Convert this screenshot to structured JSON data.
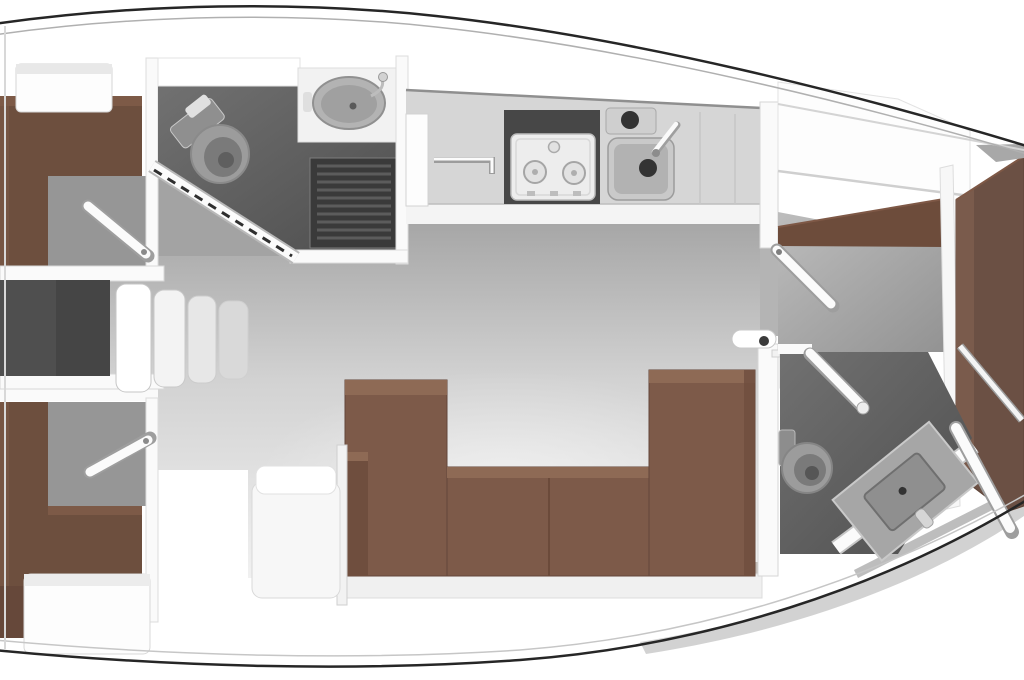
{
  "page": {
    "background": "#ffffff",
    "title": "sailing-yacht-interior-floor-plan"
  },
  "diagram": {
    "type": "yacht-floor-plan",
    "view": "top-down",
    "orientation": "bow-right",
    "rooms": [
      {
        "id": "aft-cabin-starboard",
        "fixtures": [
          "double-berth",
          "wardrobe",
          "hinged-door"
        ]
      },
      {
        "id": "aft-cabin-port",
        "fixtures": [
          "double-berth",
          "lockers",
          "hinged-door"
        ]
      },
      {
        "id": "companionway",
        "fixtures": [
          "engine-compartment",
          "four-steps"
        ]
      },
      {
        "id": "aft-head",
        "fixtures": [
          "toilet",
          "washbasin",
          "shower-grate",
          "angled-sliding-door"
        ]
      },
      {
        "id": "galley",
        "fixtures": [
          "two-burner-stove",
          "sink",
          "top-loading-box",
          "faucet",
          "lockers"
        ]
      },
      {
        "id": "salon",
        "fixtures": [
          "u-shaped-sofa",
          "seat-chest"
        ]
      },
      {
        "id": "forward-cabin",
        "fixtures": [
          "v-berth",
          "shelf",
          "overhead-lockers",
          "hinged-door"
        ]
      },
      {
        "id": "forward-head",
        "fixtures": [
          "toilet",
          "angled-washbasin-console",
          "hinged-door",
          "hinged-door"
        ]
      }
    ],
    "step_count": 4,
    "burner_count": 2,
    "palette": {
      "hull_fill": "#ffffff",
      "hull_line": "#262626",
      "sheer_line": "#b0b0b0",
      "deck_shade": "#8a8a8a",
      "wall": "#fafafa",
      "cabinet": "#fdfdfd",
      "salon_floor_top": "#a5a5a5",
      "salon_floor_mid": "#d2d2d2",
      "salon_floor_bottom": "#f1f1f1",
      "cabin_floor": "#969696",
      "corridor_floor": "#a3a3a3",
      "head_floor_light": "#717171",
      "head_floor_dark": "#4e4e4e",
      "fwd_floor_light": "#bdbdbd",
      "fwd_floor_dark": "#929292",
      "engine": "#454545",
      "engine_light": "#4f4f4f",
      "grate": "#3a3a3a",
      "grate_slat": "#5c5c5c",
      "berth": "#6d4f3e",
      "berth_light": "#7d5a47",
      "berth_deep": "#66483a",
      "sofa": "#7d5a49",
      "sofa_light": "#8e6a55",
      "sofa_dark": "#6f4e3e",
      "sofa_seam": "#6b4a3a",
      "vberth": "#6b5044",
      "vberth_light": "#7a5b4c",
      "shelf": "#6d4c3b",
      "counter": "#d6d6d6",
      "counter_front": "#f4f4f4",
      "stove_recess": "#474747",
      "stove_face": "#ededed",
      "fixture": "#9c9c9c",
      "fixture_dark": "#7a7a7a",
      "drain": "#333333",
      "door_white": "#fbfbfb",
      "door_shadow": "#9e9e9e",
      "chest": "#f7f7f7",
      "sill": "#f0f0f0"
    }
  }
}
